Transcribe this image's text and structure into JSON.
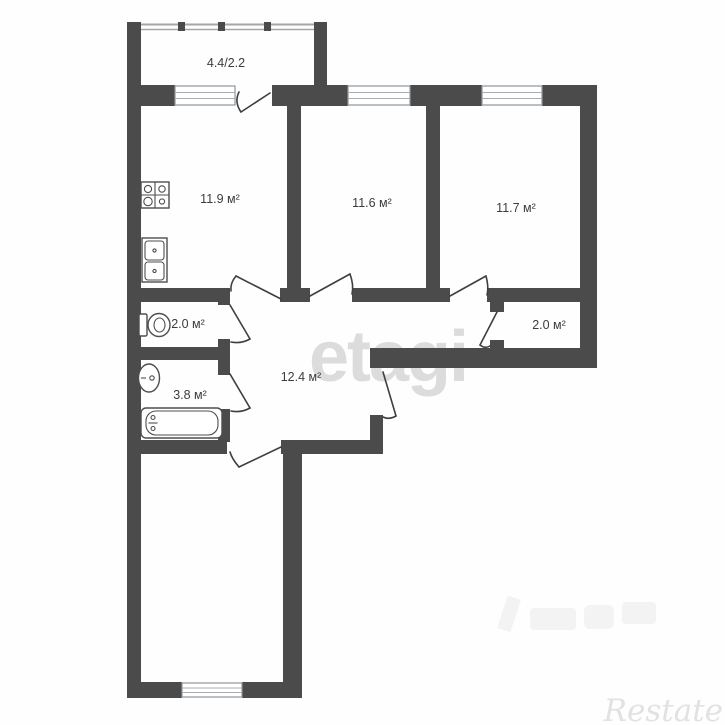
{
  "plan": {
    "title": "apartment-floor-plan",
    "balcony": {
      "label": "4.4/2.2",
      "area_total": 4.4,
      "area_reduced": 2.2
    },
    "rooms": [
      {
        "id": "kitchen",
        "label": "11.9 м²",
        "area_m2": 11.9
      },
      {
        "id": "room-middle",
        "label": "11.6 м²",
        "area_m2": 11.6
      },
      {
        "id": "room-right",
        "label": "11.7 м²",
        "area_m2": 11.7
      },
      {
        "id": "wc",
        "label": "2.0 м²",
        "area_m2": 2.0
      },
      {
        "id": "bathroom",
        "label": "3.8 м²",
        "area_m2": 3.8
      },
      {
        "id": "hallway",
        "label": "12.4 м²",
        "area_m2": 12.4
      },
      {
        "id": "closet",
        "label": "2.0 м²",
        "area_m2": 2.0
      }
    ],
    "fixtures": [
      "stove-icon",
      "kitchen-sink-icon",
      "toilet-icon",
      "wash-basin-icon",
      "bathtub-icon"
    ],
    "windows_count": 4,
    "colors": {
      "wall": "#4b4b4b",
      "label_text": "#3c3c3c",
      "window_frame": "#8f959b",
      "watermark_center": "#dcdcdc",
      "watermark_corner": "#e2e2e2"
    }
  },
  "watermarks": {
    "center": "etagi",
    "corner": "Restate"
  }
}
